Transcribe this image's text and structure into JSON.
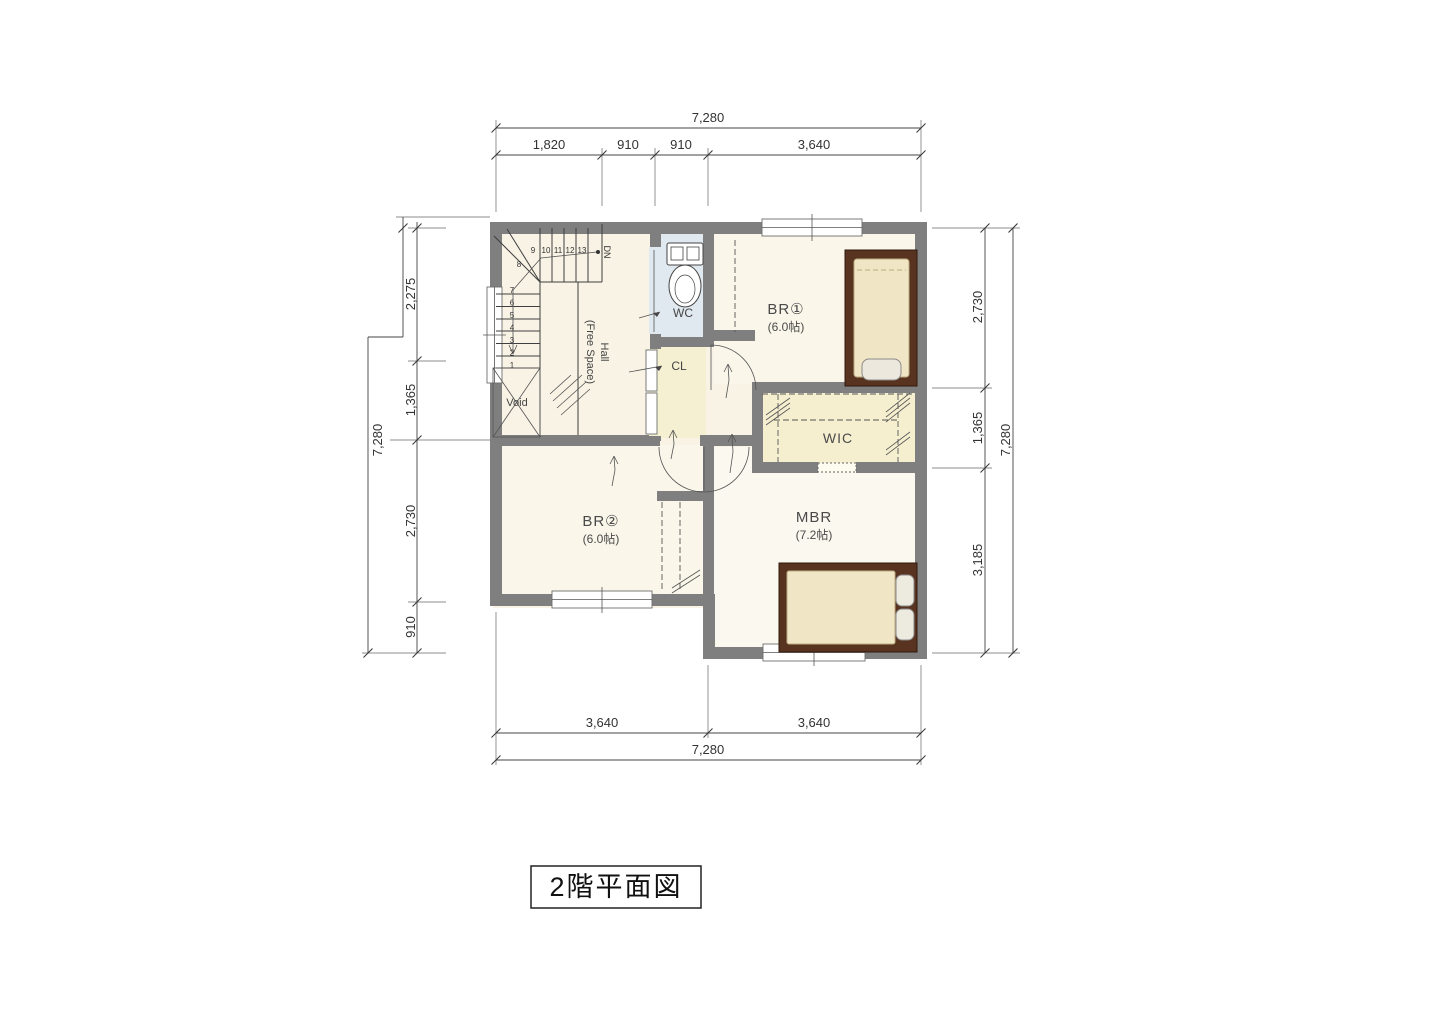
{
  "title": {
    "label": "2階平面図"
  },
  "plan": {
    "rooms": {
      "br1": {
        "name": "BR①",
        "size": "(6.0帖)"
      },
      "br2": {
        "name": "BR②",
        "size": "(6.0帖)"
      },
      "mbr": {
        "name": "MBR",
        "size": "(7.2帖)"
      },
      "wic": {
        "name": "WIC"
      },
      "wc": {
        "name": "WC"
      },
      "cl": {
        "name": "CL"
      },
      "hall": {
        "name": "Hall",
        "sub": "(Free Space)"
      },
      "void": {
        "name": "Void"
      }
    },
    "stairs": {
      "dn": "DN",
      "numbers": [
        "1",
        "2",
        "3",
        "4",
        "5",
        "6",
        "7",
        "8",
        "9",
        "10",
        "11",
        "12",
        "13"
      ]
    }
  },
  "dimensions": {
    "top": {
      "total": "7,280",
      "segments": [
        "1,820",
        "910",
        "910",
        "3,640"
      ]
    },
    "bottom": {
      "total": "7,280",
      "segments": [
        "3,640",
        "3,640"
      ]
    },
    "left": {
      "total": "7,280",
      "segments": [
        "2,275",
        "1,365",
        "2,730",
        "910"
      ]
    },
    "right": {
      "total": "7,280",
      "segments": [
        "2,730",
        "1,365",
        "3,185"
      ]
    }
  },
  "colors": {
    "wall": "#7f7f7f",
    "floor": "#f8f3e5",
    "room_floor": "#faf6ec",
    "wc_floor": "#e1e9f0",
    "closet_floor": "#f6f0d2",
    "wic_floor": "#f5efd0",
    "bed_frame": "#583320",
    "mattress": "#f0e5c4",
    "line": "#444444"
  }
}
